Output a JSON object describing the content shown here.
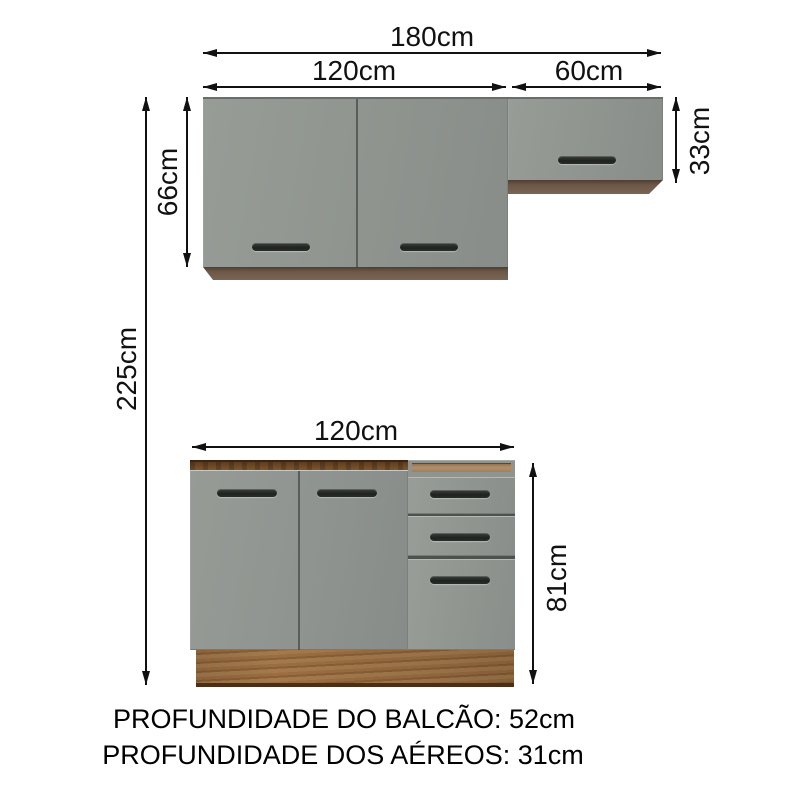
{
  "diagram": {
    "dims": {
      "total_width": "180cm",
      "wall_left_width": "120cm",
      "wall_right_width": "60cm",
      "wall_left_height": "66cm",
      "wall_right_height": "33cm",
      "total_height": "225cm",
      "base_width": "120cm",
      "base_height": "81cm"
    },
    "notes": {
      "counter_depth": "PROFUNDIDADE DO BALCÃO: 52cm",
      "wall_units_depth": "PROFUNDIDADE DOS AÉREOS: 31cm"
    },
    "colors": {
      "door_gray": "#8e938f",
      "trim_wood": "#6d5848",
      "plinth_wood": "#96693f",
      "interior_wood_dark": "#6f4a26",
      "interior_wood_light": "#b09070",
      "handle_black": "#262926",
      "dimension_line": "#111111",
      "background": "#ffffff"
    }
  }
}
